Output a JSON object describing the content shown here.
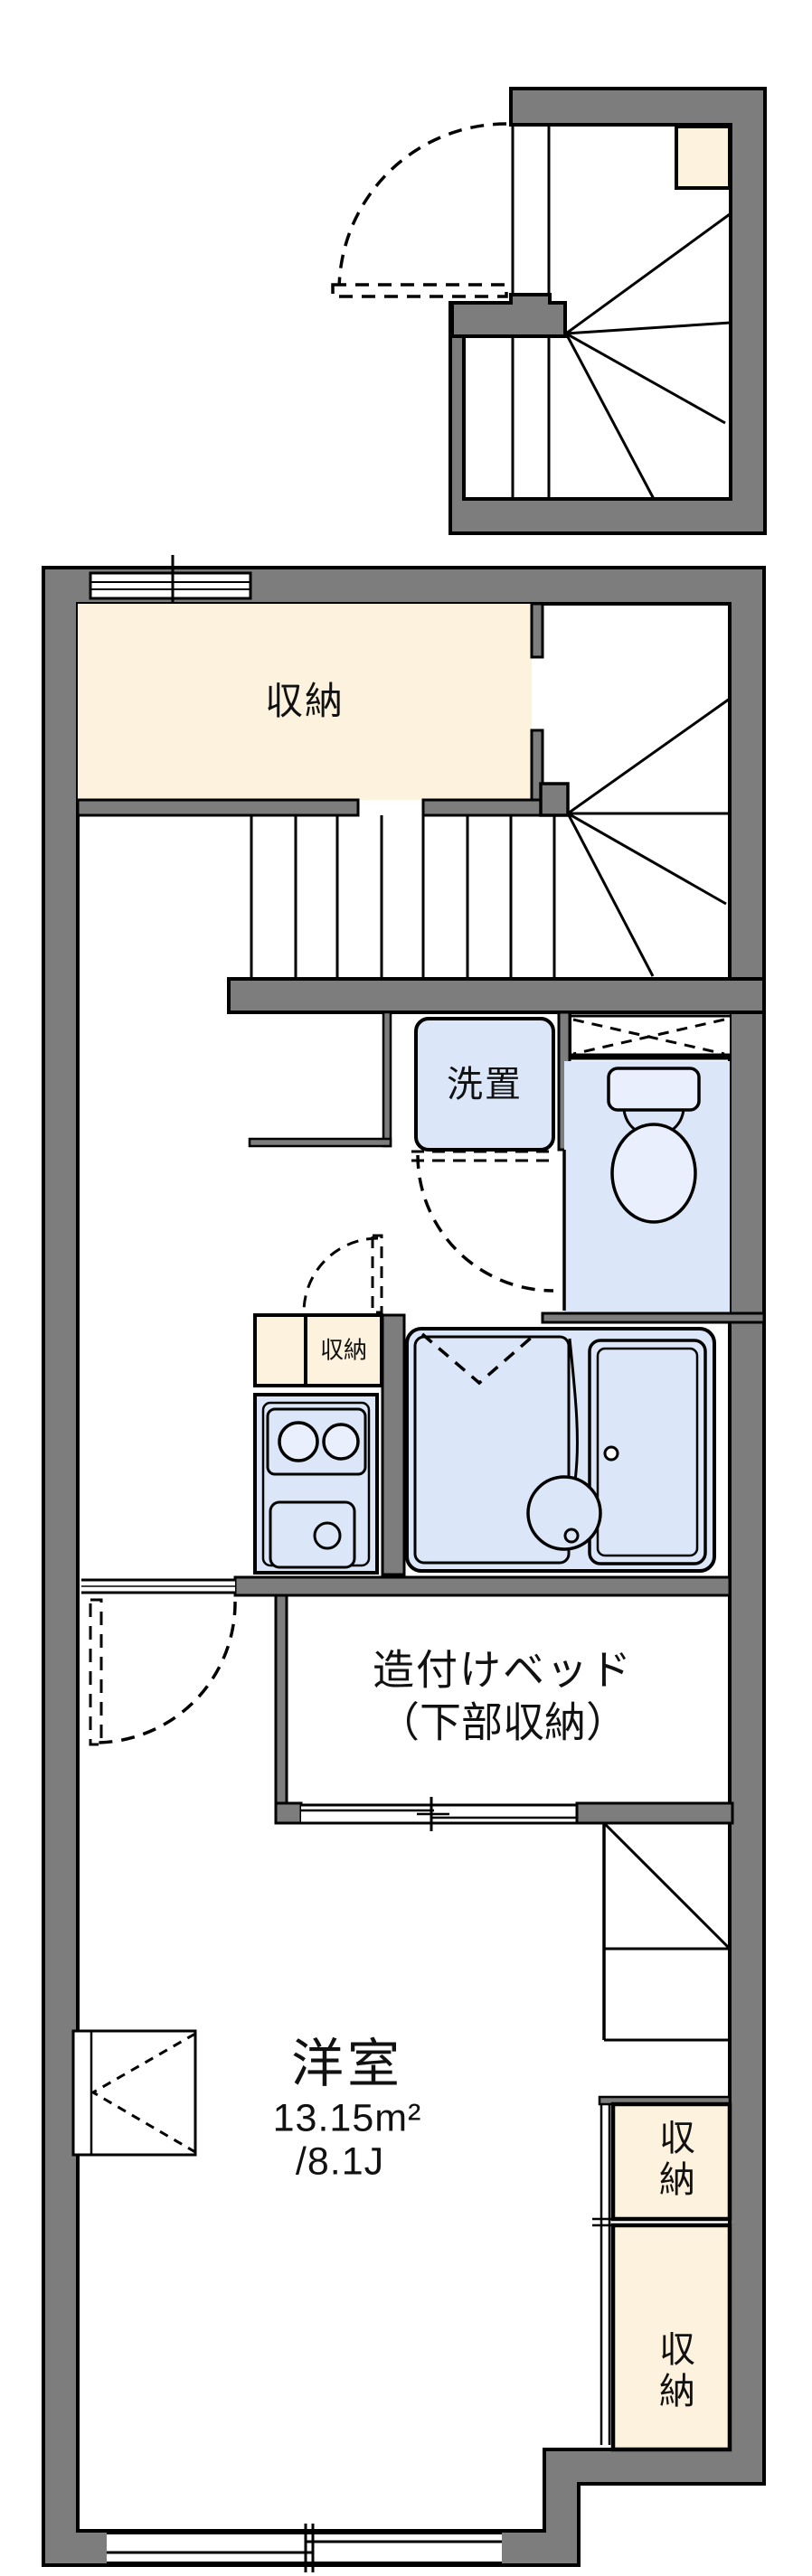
{
  "document": {
    "type": "floor-plan",
    "language": "ja"
  },
  "colors": {
    "wall": "#7d7d7d",
    "outline": "#000000",
    "storage_fill": "#fcf2dd",
    "fixture_fill": "#dbe7f8",
    "fixture_fill_light": "#e9effc",
    "background": "#ffffff"
  },
  "labels": {
    "storage_upper": "収納",
    "washer_space": "洗置",
    "kitchen_storage": "収納",
    "built_in_bed_line1": "造付けベッド",
    "built_in_bed_line2": "（下部収納）",
    "room_name": "洋室",
    "room_area": "13.15m²",
    "room_tatami": "/8.1J",
    "closet_upper": "収納",
    "closet_lower": "収納"
  }
}
